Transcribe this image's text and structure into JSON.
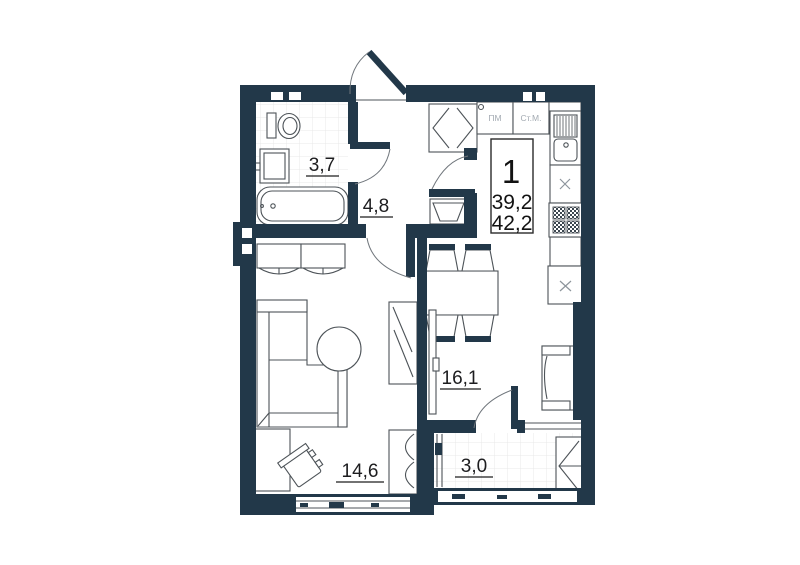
{
  "unit_card": {
    "rooms_count": "1",
    "living_area": "39,2",
    "total_area": "42,2"
  },
  "rooms": {
    "bathroom": "3,7",
    "hallway": "4,8",
    "kitchen_living": "16,1",
    "bedroom": "14,6",
    "balcony": "3,0"
  },
  "appliances": {
    "dishwasher": "ПМ",
    "washer": "Ст.М."
  },
  "colors": {
    "wall": "#223849",
    "furniture_line": "#4d5358",
    "label_text": "#1d1d1f",
    "appliance_text": "#a3aab2",
    "tile_line": "#e9e9e9",
    "background": "#ffffff"
  }
}
